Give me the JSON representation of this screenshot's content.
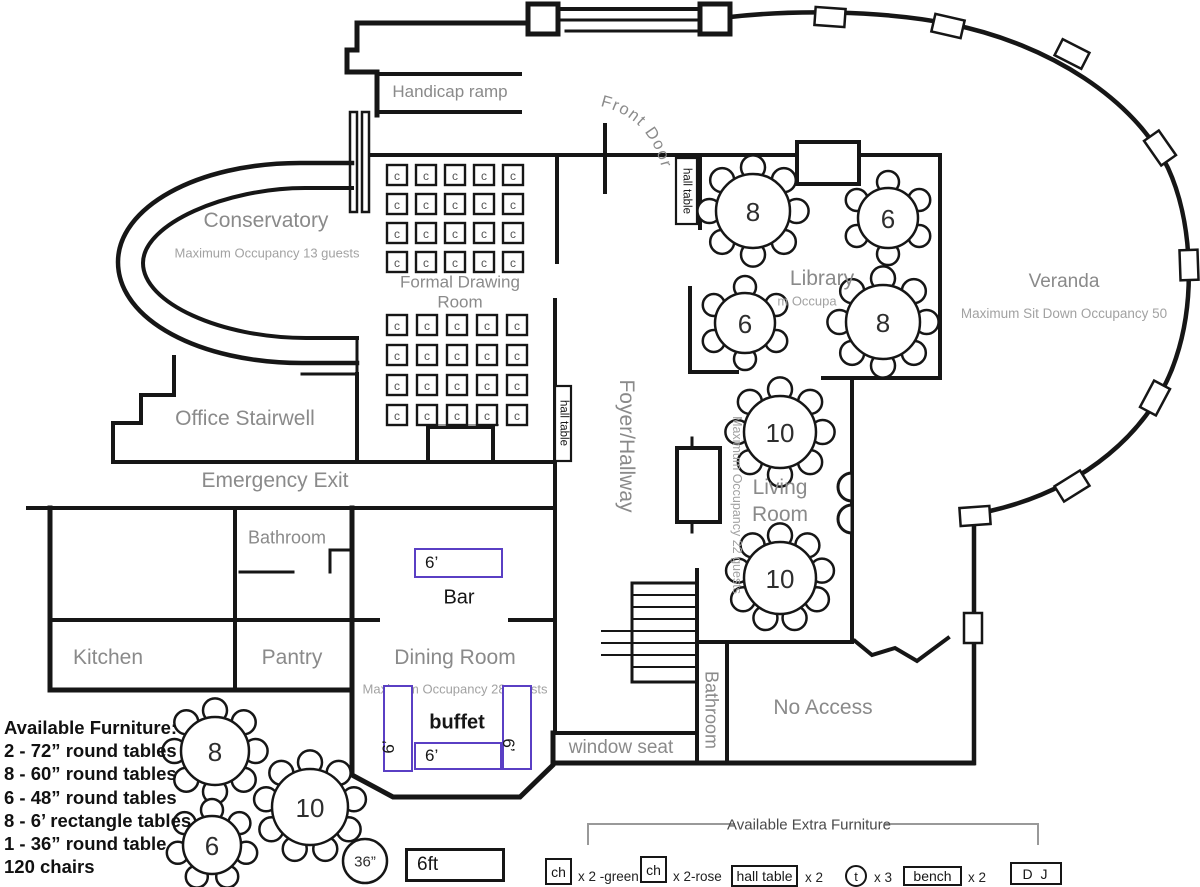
{
  "colors": {
    "wall": "#161616",
    "room_label": "#8a8a8a",
    "occupancy_label": "#a2a2a2",
    "furniture_accent": "#5a3fc4"
  },
  "rooms": {
    "conservatory": {
      "name": "Conservatory",
      "occupancy": "Maximum Occupancy 13 guests"
    },
    "formal_drawing_room": {
      "name": "Formal Drawing Room"
    },
    "office_stairwell": {
      "name": "Office Stairwell"
    },
    "emergency_exit": {
      "name": "Emergency Exit"
    },
    "bathroom_upper": {
      "name": "Bathroom"
    },
    "kitchen": {
      "name": "Kitchen"
    },
    "pantry": {
      "name": "Pantry"
    },
    "dining_room": {
      "name": "Dining Room",
      "occupancy": "Maximum Occupancy 28 guests"
    },
    "foyer": {
      "name": "Foyer/Hallway"
    },
    "library": {
      "name": "Library",
      "occupancy_fragment": "m Occupa"
    },
    "living_room": {
      "name": "Living Room",
      "occupancy": "Maximum Occupancy 22 guests"
    },
    "veranda": {
      "name": "Veranda",
      "occupancy": "Maximum Sit Down Occupancy 50"
    },
    "bathroom_lower": {
      "name": "Bathroom"
    },
    "no_access": {
      "name": "No Access"
    },
    "window_seat": {
      "name": "window seat"
    },
    "handicap_ramp": {
      "name": "Handicap ramp"
    },
    "front_door": {
      "name": "Front Door"
    }
  },
  "fixtures": {
    "bar": {
      "size": "6’",
      "label": "Bar"
    },
    "buffet": {
      "label": "buffet",
      "left_size": "6’",
      "center_size": "6’",
      "right_size": "6’"
    },
    "hall_table_top": "hall table",
    "hall_table_side": "hall table",
    "chair_glyph": "c"
  },
  "chair_grids": [
    {
      "x": 387,
      "y": 165,
      "rows": 4,
      "cols": 5,
      "pitch": 29,
      "cell": 20
    },
    {
      "x": 387,
      "y": 315,
      "rows": 4,
      "cols": 5,
      "pitch": 30,
      "cell": 20
    }
  ],
  "round_tables": [
    {
      "area": "library",
      "label": "8",
      "x": 753,
      "y": 211,
      "r": 37,
      "chairs": 8
    },
    {
      "area": "library",
      "label": "6",
      "x": 888,
      "y": 218,
      "r": 30,
      "chairs": 6
    },
    {
      "area": "library",
      "label": "6",
      "x": 745,
      "y": 323,
      "r": 30,
      "chairs": 6
    },
    {
      "area": "library",
      "label": "8",
      "x": 883,
      "y": 322,
      "r": 37,
      "chairs": 8
    },
    {
      "area": "living_room",
      "label": "10",
      "x": 780,
      "y": 432,
      "r": 36,
      "chairs": 8
    },
    {
      "area": "living_room",
      "label": "10",
      "x": 780,
      "y": 578,
      "r": 36,
      "chairs": 9
    },
    {
      "area": "spare",
      "label": "8",
      "x": 215,
      "y": 751,
      "r": 34,
      "chairs": 8
    },
    {
      "area": "spare",
      "label": "6",
      "x": 212,
      "y": 845,
      "r": 29,
      "chairs": 7
    },
    {
      "area": "spare",
      "label": "10",
      "x": 310,
      "y": 807,
      "r": 38,
      "chairs": 9
    },
    {
      "area": "spare",
      "label": "36”",
      "x": 365,
      "y": 861,
      "r": 22,
      "chairs": 0,
      "small": true
    }
  ],
  "sample_shapes": {
    "rect_label": "6ft"
  },
  "available_furniture": {
    "title": "Available Furniture:",
    "items": [
      "2 - 72” round tables",
      "8 - 60” round tables",
      "6 - 48” round tables",
      "8 - 6’ rectangle tables",
      "1 - 36” round table",
      "120 chairs"
    ]
  },
  "extra_furniture": {
    "title": "Available Extra Furniture",
    "items": [
      {
        "box": "ch",
        "qty": "x 2 -green"
      },
      {
        "box": "ch",
        "qty": "x 2-rose"
      },
      {
        "box": "hall table",
        "qty": "x 2"
      },
      {
        "box": "t",
        "qty": "x 3"
      },
      {
        "box": "bench",
        "qty": "x 2"
      },
      {
        "box": "D J",
        "qty": ""
      }
    ]
  }
}
